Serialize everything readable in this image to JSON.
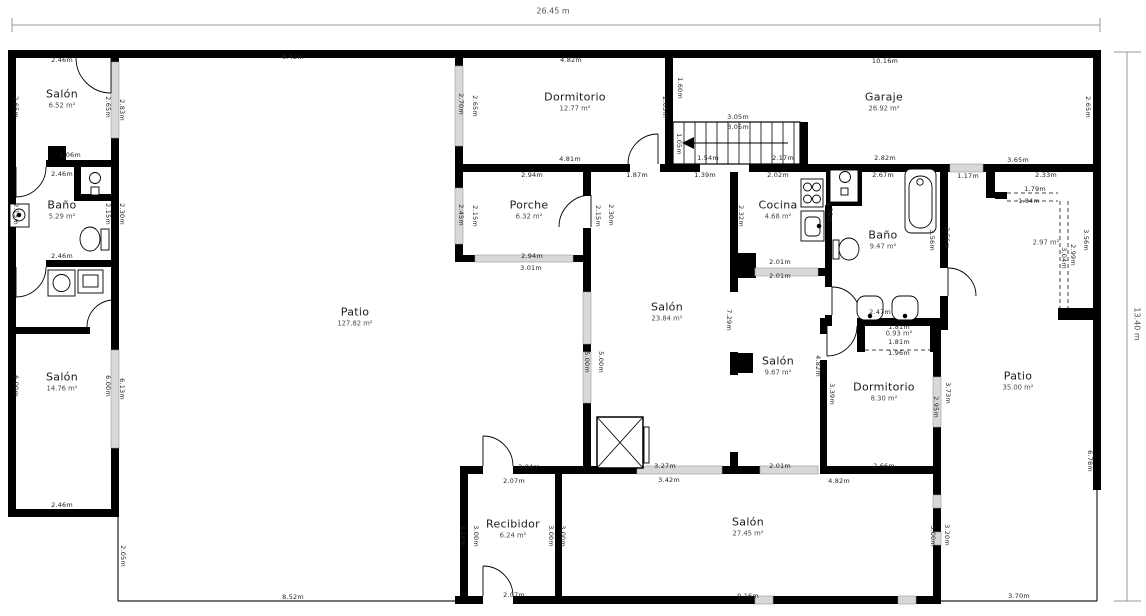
{
  "plan": {
    "overall": {
      "width_label": "26.45 m",
      "height_label": "13.40 m"
    },
    "rooms": [
      {
        "name": "Salón",
        "area": "6.52 m²",
        "x": 62,
        "y": 99
      },
      {
        "name": "Baño",
        "area": "5.29 m²",
        "x": 62,
        "y": 210
      },
      {
        "name": "Salón",
        "area": "14.76 m²",
        "x": 62,
        "y": 382
      },
      {
        "name": "Patio",
        "area": "127.82 m²",
        "x": 355,
        "y": 317
      },
      {
        "name": "Dormitorio",
        "area": "12.77 m²",
        "x": 575,
        "y": 102
      },
      {
        "name": "Garaje",
        "area": "26.92 m²",
        "x": 884,
        "y": 102
      },
      {
        "name": "Porche",
        "area": "6.32 m²",
        "x": 529,
        "y": 210
      },
      {
        "name": "Cocina",
        "area": "4.68 m²",
        "x": 778,
        "y": 210
      },
      {
        "name": "Baño",
        "area": "9.47 m²",
        "x": 883,
        "y": 240
      },
      {
        "name": "Salón",
        "area": "23.84 m²",
        "x": 667,
        "y": 312
      },
      {
        "name": "Salón",
        "area": "9.67 m²",
        "x": 778,
        "y": 366
      },
      {
        "name": "Dormitorio",
        "area": "8.30 m²",
        "x": 884,
        "y": 392
      },
      {
        "name": "Patio",
        "area": "35.00 m²",
        "x": 1018,
        "y": 381
      },
      {
        "name": "Recibidor",
        "area": "6.24 m²",
        "x": 513,
        "y": 529
      },
      {
        "name": "Salón",
        "area": "27.45 m²",
        "x": 748,
        "y": 527
      },
      {
        "name": "",
        "area": "2.97 m²",
        "x": 1046,
        "y": 243
      },
      {
        "name": "",
        "area": "0.93 m²",
        "x": 899,
        "y": 334
      }
    ],
    "dims": [
      {
        "t": "8.42m",
        "x": 293,
        "y": 57
      },
      {
        "t": "2.46m",
        "x": 62,
        "y": 60
      },
      {
        "t": "2.65m",
        "x": 16,
        "y": 107,
        "v": true
      },
      {
        "t": "2.65m",
        "x": 108,
        "y": 107,
        "v": true
      },
      {
        "t": "2.83m",
        "x": 122,
        "y": 110,
        "v": true
      },
      {
        "t": "1.06m",
        "x": 70,
        "y": 155
      },
      {
        "t": "2.46m",
        "x": 62,
        "y": 174
      },
      {
        "t": "2.15m",
        "x": 16,
        "y": 214,
        "v": true
      },
      {
        "t": "2.15m",
        "x": 108,
        "y": 214,
        "v": true
      },
      {
        "t": "2.30m",
        "x": 122,
        "y": 214,
        "v": true
      },
      {
        "t": "2.46m",
        "x": 62,
        "y": 256
      },
      {
        "t": "6.00m",
        "x": 16,
        "y": 386,
        "v": true
      },
      {
        "t": "6.00m",
        "x": 108,
        "y": 386,
        "v": true
      },
      {
        "t": "6.13m",
        "x": 122,
        "y": 389,
        "v": true
      },
      {
        "t": "2.46m",
        "x": 62,
        "y": 505
      },
      {
        "t": "2.05m",
        "x": 123,
        "y": 556,
        "v": true
      },
      {
        "t": "8.52m",
        "x": 293,
        "y": 597
      },
      {
        "t": "4.82m",
        "x": 571,
        "y": 60
      },
      {
        "t": "2.70m",
        "x": 461,
        "y": 104,
        "v": true
      },
      {
        "t": "2.65m",
        "x": 475,
        "y": 106,
        "v": true
      },
      {
        "t": "2.65m",
        "x": 665,
        "y": 107,
        "v": true
      },
      {
        "t": "1.60m",
        "x": 680,
        "y": 88,
        "v": true
      },
      {
        "t": "4.81m",
        "x": 570,
        "y": 159
      },
      {
        "t": "1.54m",
        "x": 708,
        "y": 158
      },
      {
        "t": "2.17m",
        "x": 783,
        "y": 158
      },
      {
        "t": "2.82m",
        "x": 885,
        "y": 158
      },
      {
        "t": "3.05m",
        "x": 738,
        "y": 117
      },
      {
        "t": "3.05m",
        "x": 738,
        "y": 127
      },
      {
        "t": "1.05m",
        "x": 679,
        "y": 144,
        "v": true
      },
      {
        "t": "2.94m",
        "x": 532,
        "y": 175
      },
      {
        "t": "1.87m",
        "x": 637,
        "y": 175
      },
      {
        "t": "1.39m",
        "x": 705,
        "y": 175
      },
      {
        "t": "10.16m",
        "x": 885,
        "y": 61
      },
      {
        "t": "2.65m",
        "x": 1088,
        "y": 107,
        "v": true
      },
      {
        "t": "2.02m",
        "x": 778,
        "y": 175
      },
      {
        "t": "2.67m",
        "x": 883,
        "y": 175
      },
      {
        "t": "1.17m",
        "x": 968,
        "y": 176
      },
      {
        "t": "3.65m",
        "x": 1018,
        "y": 160
      },
      {
        "t": "2.33m",
        "x": 1046,
        "y": 175
      },
      {
        "t": "1.79m",
        "x": 1035,
        "y": 189
      },
      {
        "t": "1.84m",
        "x": 1029,
        "y": 201
      },
      {
        "t": "2.45m",
        "x": 461,
        "y": 215,
        "v": true
      },
      {
        "t": "2.15m",
        "x": 475,
        "y": 216,
        "v": true
      },
      {
        "t": "2.15m",
        "x": 598,
        "y": 216,
        "v": true
      },
      {
        "t": "2.30m",
        "x": 611,
        "y": 215,
        "v": true
      },
      {
        "t": "2.94m",
        "x": 532,
        "y": 256
      },
      {
        "t": "3.01m",
        "x": 531,
        "y": 268
      },
      {
        "t": "2.32m",
        "x": 741,
        "y": 216,
        "v": true
      },
      {
        "t": "2.38m",
        "x": 830,
        "y": 212,
        "v": true
      },
      {
        "t": "2.01m",
        "x": 780,
        "y": 262
      },
      {
        "t": "2.01m",
        "x": 780,
        "y": 276
      },
      {
        "t": "3.56m",
        "x": 932,
        "y": 240,
        "v": true
      },
      {
        "t": "3.56m",
        "x": 947,
        "y": 238,
        "v": true
      },
      {
        "t": "3.56m",
        "x": 1086,
        "y": 240,
        "v": true
      },
      {
        "t": "3.04m",
        "x": 1064,
        "y": 258,
        "v": true
      },
      {
        "t": "2.99m",
        "x": 1073,
        "y": 255,
        "v": true
      },
      {
        "t": "7.29m",
        "x": 729,
        "y": 320,
        "v": true
      },
      {
        "t": "5.00m",
        "x": 587,
        "y": 362,
        "v": true
      },
      {
        "t": "5.00m",
        "x": 601,
        "y": 362,
        "v": true
      },
      {
        "t": "4.82m",
        "x": 818,
        "y": 366,
        "v": true
      },
      {
        "t": "2.47m",
        "x": 880,
        "y": 312
      },
      {
        "t": "1.81m",
        "x": 899,
        "y": 327
      },
      {
        "t": "1.81m",
        "x": 899,
        "y": 342
      },
      {
        "t": "1.96m",
        "x": 899,
        "y": 353
      },
      {
        "t": "3.39m",
        "x": 832,
        "y": 394,
        "v": true
      },
      {
        "t": "2.95m",
        "x": 936,
        "y": 407,
        "v": true
      },
      {
        "t": "3.73m",
        "x": 948,
        "y": 393,
        "v": true
      },
      {
        "t": "2.66m",
        "x": 884,
        "y": 466
      },
      {
        "t": "4.82m",
        "x": 839,
        "y": 481
      },
      {
        "t": "2.01m",
        "x": 780,
        "y": 466
      },
      {
        "t": "3.27m",
        "x": 665,
        "y": 466
      },
      {
        "t": "3.42m",
        "x": 669,
        "y": 480
      },
      {
        "t": "3.04m",
        "x": 529,
        "y": 467
      },
      {
        "t": "2.07m",
        "x": 514,
        "y": 481
      },
      {
        "t": "3.20m",
        "x": 463,
        "y": 536,
        "v": true
      },
      {
        "t": "3.00m",
        "x": 476,
        "y": 536,
        "v": true
      },
      {
        "t": "3.00m",
        "x": 551,
        "y": 536,
        "v": true
      },
      {
        "t": "3.00m",
        "x": 563,
        "y": 536,
        "v": true
      },
      {
        "t": "3.00m",
        "x": 933,
        "y": 536,
        "v": true
      },
      {
        "t": "3.20m",
        "x": 947,
        "y": 535,
        "v": true
      },
      {
        "t": "2.07m",
        "x": 514,
        "y": 595
      },
      {
        "t": "9.16m",
        "x": 748,
        "y": 596
      },
      {
        "t": "3.70m",
        "x": 1019,
        "y": 596
      },
      {
        "t": "6.78m",
        "x": 1090,
        "y": 461,
        "v": true
      }
    ]
  }
}
